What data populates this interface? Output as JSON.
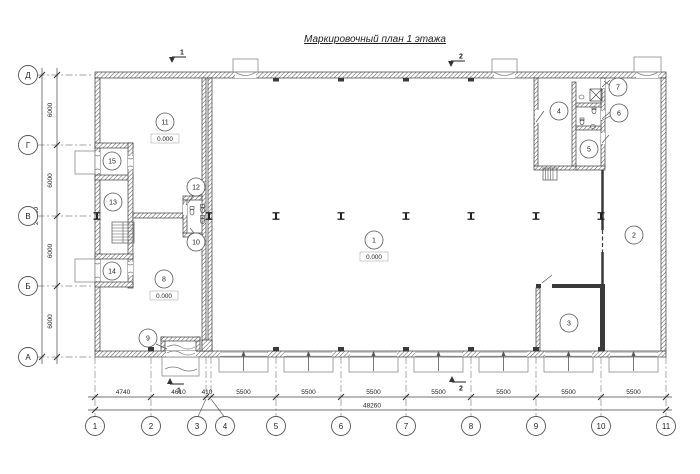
{
  "title": "Маркировочный план 1 этажа",
  "axes": {
    "rows": [
      {
        "label": "Д"
      },
      {
        "label": "Г"
      },
      {
        "label": "В"
      },
      {
        "label": "Б"
      },
      {
        "label": "А"
      }
    ],
    "cols": [
      {
        "label": "1"
      },
      {
        "label": "2"
      },
      {
        "label": "3"
      },
      {
        "label": "4"
      },
      {
        "label": "5"
      },
      {
        "label": "6"
      },
      {
        "label": "7"
      },
      {
        "label": "8"
      },
      {
        "label": "9"
      },
      {
        "label": "10"
      },
      {
        "label": "11"
      }
    ]
  },
  "dimensions": {
    "left_chain": [
      "6000",
      "6000",
      "6000",
      "6000"
    ],
    "left_total": "24000",
    "bottom_chain": [
      "4740",
      "4610",
      "410",
      "5500",
      "5500",
      "5500",
      "5500",
      "5500",
      "5500",
      "5500"
    ],
    "bottom_total": "48260"
  },
  "rooms": [
    {
      "number": "1",
      "elevation": "0.000"
    },
    {
      "number": "2"
    },
    {
      "number": "3"
    },
    {
      "number": "4"
    },
    {
      "number": "5"
    },
    {
      "number": "6"
    },
    {
      "number": "7"
    },
    {
      "number": "8",
      "elevation": "0.000"
    },
    {
      "number": "9"
    },
    {
      "number": "10"
    },
    {
      "number": "11",
      "elevation": "0.000"
    },
    {
      "number": "12"
    },
    {
      "number": "13"
    },
    {
      "number": "14"
    },
    {
      "number": "15"
    }
  ],
  "section_marks": [
    {
      "label": "1"
    },
    {
      "label": "2"
    },
    {
      "label": "1"
    },
    {
      "label": "2"
    }
  ],
  "colors": {
    "line": "#3a3a3a",
    "dim": "#444444",
    "thin": "#8a8a8a",
    "hatch": "#555555",
    "dash": "#888888"
  }
}
